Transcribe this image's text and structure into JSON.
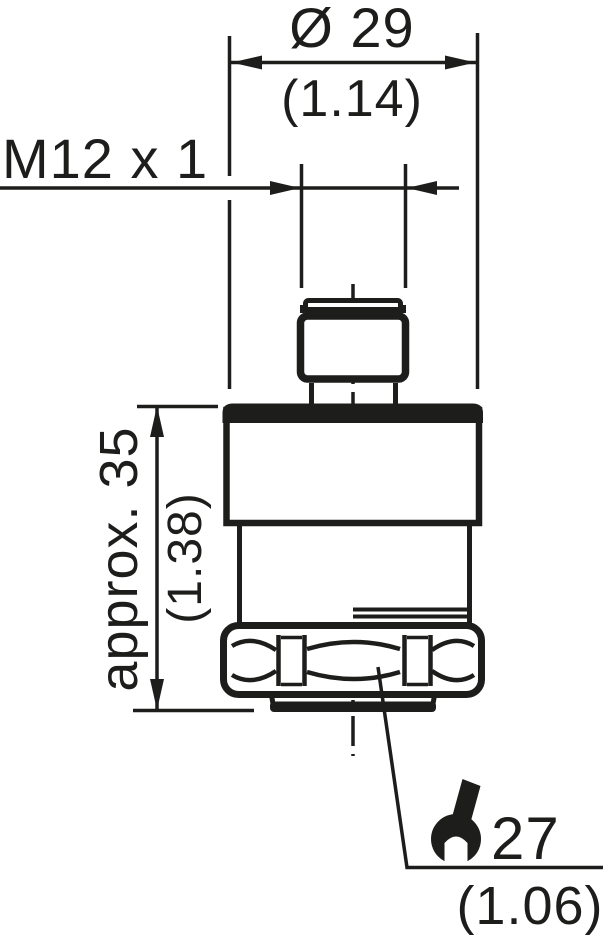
{
  "meta": {
    "ink_color": "#1d1d1b",
    "background_color": "#ffffff"
  },
  "labels": {
    "diameter": {
      "metric": "Ø 29",
      "imperial": "(1.14)"
    },
    "thread": {
      "metric": "M12 x 1"
    },
    "height": {
      "metric": "approx. 35",
      "imperial": "(1.38)"
    },
    "wrench_size": {
      "metric": "27",
      "imperial": "(1.06)"
    }
  },
  "icons": {
    "wrench": "open-end-wrench"
  }
}
